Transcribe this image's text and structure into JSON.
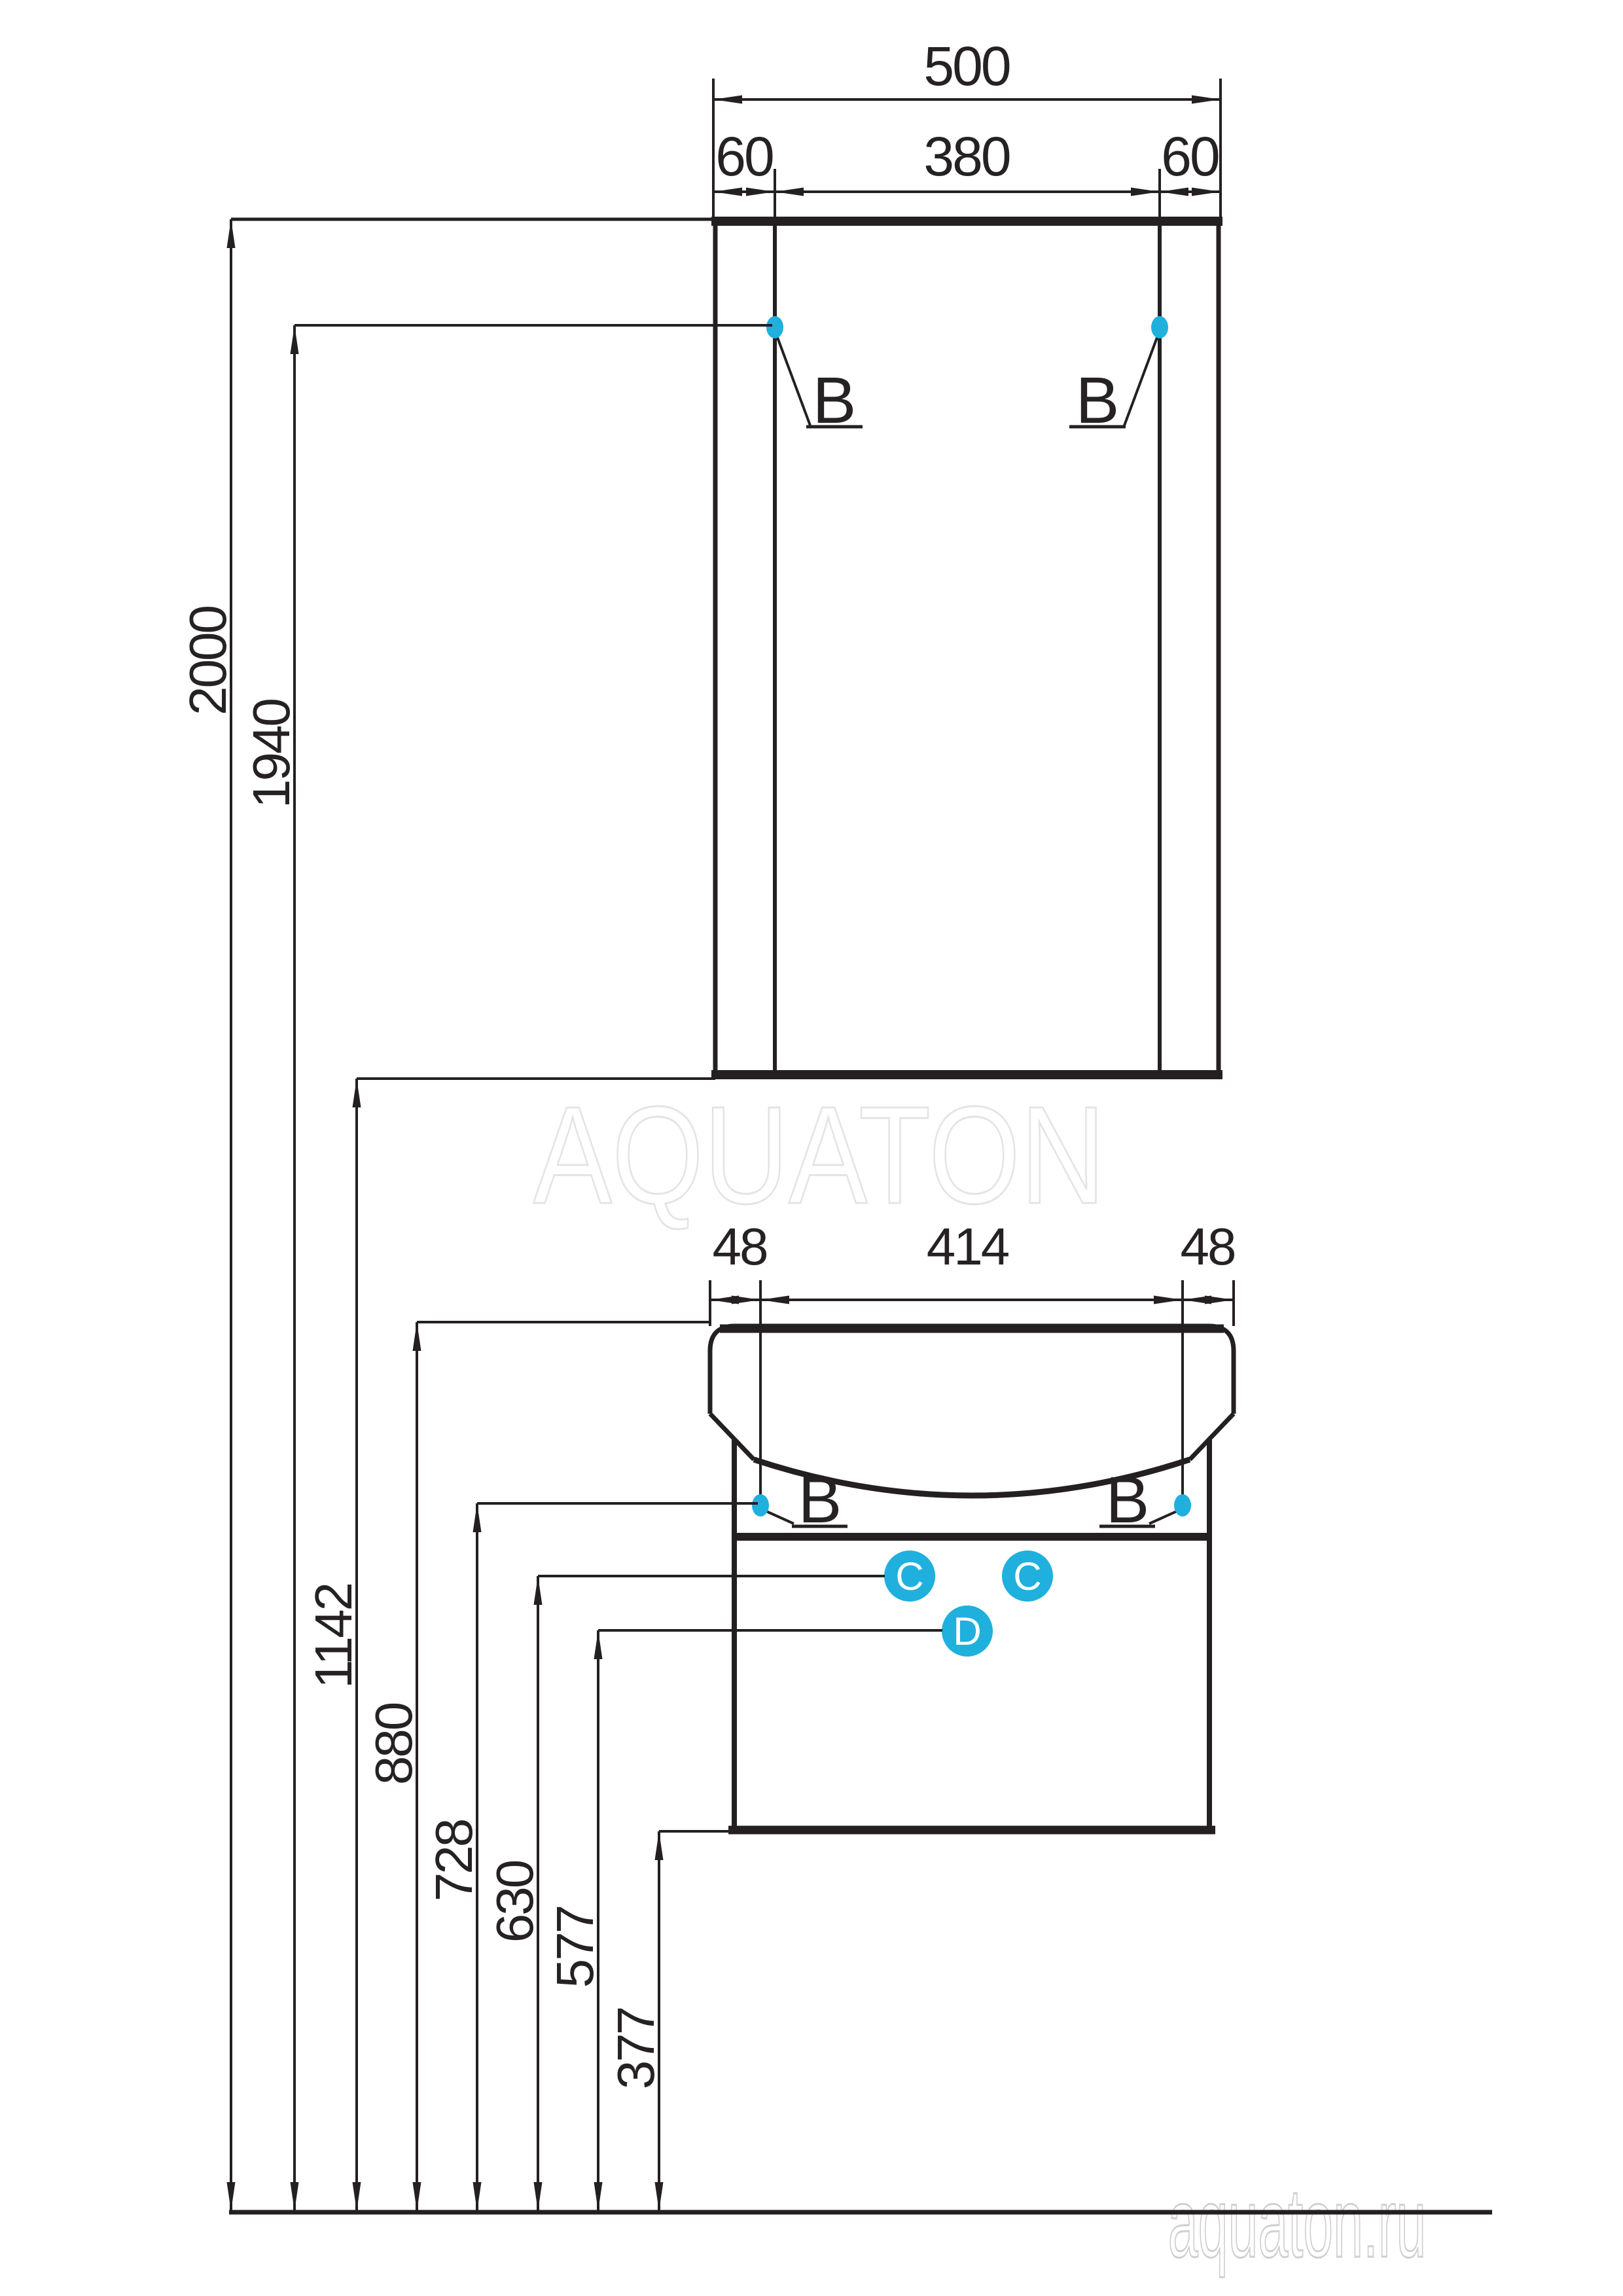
{
  "drawing": {
    "watermark": "AQUATON",
    "site": "aquaton.ru",
    "mirror": {
      "total_width": "500",
      "left_offset": "60",
      "center_width": "380",
      "right_offset": "60",
      "fix_left": "B",
      "fix_right": "B"
    },
    "vanity": {
      "left_offset": "48",
      "center_width": "414",
      "right_offset": "48",
      "fix_left": "B",
      "fix_right": "B",
      "hole_c1": "C",
      "hole_c2": "C",
      "hole_d": "D"
    },
    "heights": {
      "h2000": "2000",
      "h1940": "1940",
      "h1142": "1142",
      "h880": "880",
      "h728": "728",
      "h630": "630",
      "h577": "577",
      "h377": "377"
    },
    "colors": {
      "line": "#242021",
      "accent": "#1fb0dd",
      "watermark": "#e4e4e4",
      "site_gray": "#cfcfcf"
    }
  }
}
